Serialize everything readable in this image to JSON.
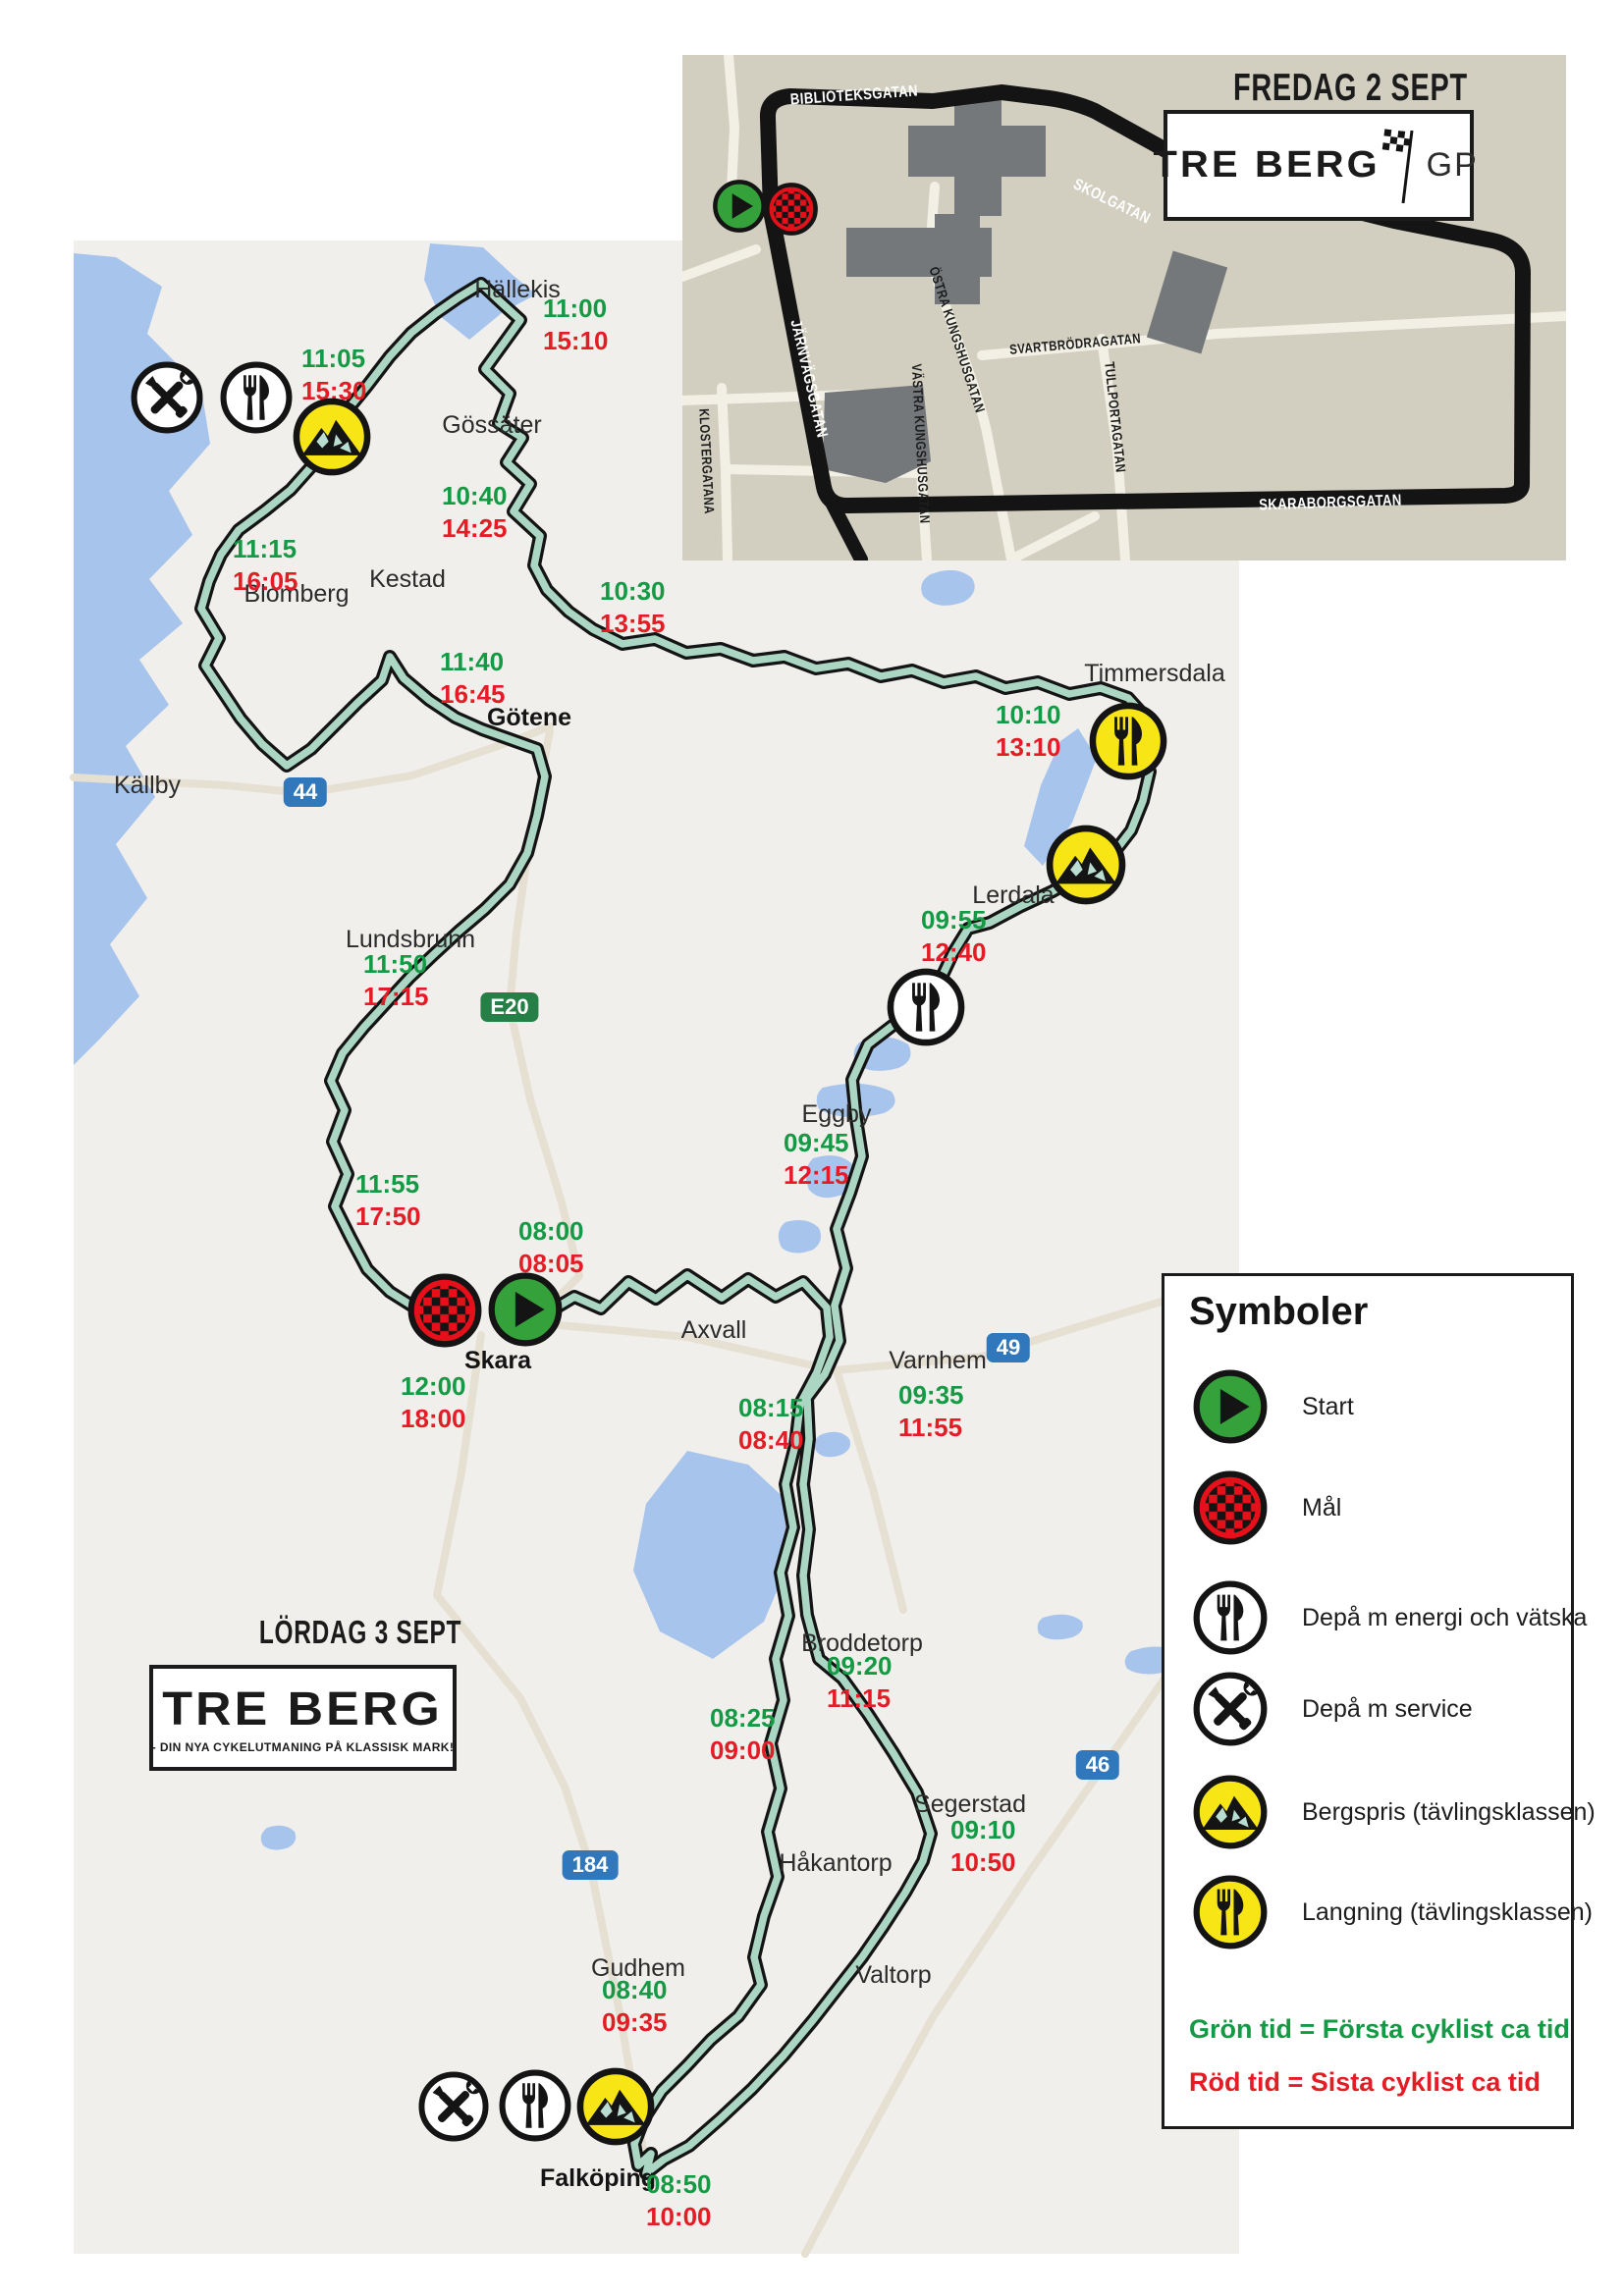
{
  "colors": {
    "map_bg": "#f0efec",
    "water": "#a6c4ec",
    "road": "#e6e0d2",
    "route_fill": "#abd6c4",
    "route_casing": "#141414",
    "green_time": "#149a44",
    "red_time": "#e31c25",
    "badge_blue": "#3077bc",
    "badge_green": "#267f46",
    "inset_bg": "#d2cfc0",
    "inset_street": "#f2f0e5",
    "building": "#75787b",
    "start_green": "#35a13b",
    "goal_red": "#e6101b",
    "prize_yellow": "#f7e516"
  },
  "inset": {
    "title": "FREDAG 2 SEPT",
    "logo_text": "TRE BERG",
    "logo_suffix": "GP",
    "streets": {
      "biblioteksgatan": "BIBLIOTEKSGATAN",
      "skolgatan": "SKOLGATAN",
      "jarnvagsgatan": "JÄRNVÄGSGATAN",
      "ostra_kungshusgatan": "ÖSTRA KUNGSHUSGATAN",
      "svartbrodragatan": "SVARTBRÖDRAGATAN",
      "tullportagatan": "TULLPORTAGATAN",
      "vastra_kungshusgatan": "VÄSTRA KUNGSHUSGATAN",
      "klostergatana": "KLOSTERGATANA",
      "skaraborgsgatan": "SKARABORGSGATAN"
    }
  },
  "main": {
    "day_title": "LÖRDAG 3 SEPT",
    "logo_text": "TRE BERG",
    "logo_tagline": "- DIN NYA CYKELUTMANING PÅ KLASSISK MARK!",
    "badges": {
      "r44": "44",
      "e20": "E20",
      "r49": "49",
      "r46": "46",
      "r184": "184"
    },
    "places": {
      "hallekis": "Hällekis",
      "gossater": "Gössäter",
      "kestad": "Kestad",
      "blomberg": "Blomberg",
      "gotene": "Götene",
      "kallby": "Källby",
      "lundsbrunn": "Lundsbrunn",
      "timmersdala": "Timmersdala",
      "lerdala": "Lerdala",
      "eggby": "Eggby",
      "skara": "Skara",
      "axvall": "Axvall",
      "varnhem": "Varnhem",
      "broddetorp": "Broddetorp",
      "hakantorp": "Håkantorp",
      "segerstad": "Segerstad",
      "valtorp": "Valtorp",
      "gudhem": "Gudhem",
      "falkoping": "Falköping"
    },
    "times": {
      "hallekis": {
        "g": "11:00",
        "r": "15:10"
      },
      "nw_bergspris": {
        "g": "11:05",
        "r": "15:30"
      },
      "gossater": {
        "g": "10:40",
        "r": "14:25"
      },
      "blomberg": {
        "g": "11:15",
        "r": "16:05"
      },
      "kestad_east": {
        "g": "10:30",
        "r": "13:55"
      },
      "gotene": {
        "g": "11:40",
        "r": "16:45"
      },
      "timmersdala": {
        "g": "10:10",
        "r": "13:10"
      },
      "lerdala": {
        "g": "09:55",
        "r": "12:40"
      },
      "eggby": {
        "g": "09:45",
        "r": "12:15"
      },
      "lundsbrunn": {
        "g": "11:50",
        "r": "17:15"
      },
      "south_lundsbrunn": {
        "g": "11:55",
        "r": "17:50"
      },
      "start": {
        "g": "08:00",
        "r": "08:05"
      },
      "mal": {
        "g": "12:00",
        "r": "18:00"
      },
      "axvall": {
        "g": "08:15",
        "r": "08:40"
      },
      "varnhem": {
        "g": "09:35",
        "r": "11:55"
      },
      "broddetorp": {
        "g": "09:20",
        "r": "11:15"
      },
      "west_broddetorp": {
        "g": "08:25",
        "r": "09:00"
      },
      "segerstad": {
        "g": "09:10",
        "r": "10:50"
      },
      "gudhem": {
        "g": "08:40",
        "r": "09:35"
      },
      "falkoping": {
        "g": "08:50",
        "r": "10:00"
      }
    }
  },
  "legend": {
    "title": "Symboler",
    "items": [
      {
        "icon": "start",
        "label": "Start"
      },
      {
        "icon": "mal",
        "label": "Mål"
      },
      {
        "icon": "depa-energi",
        "label": "Depå m energi och vätska"
      },
      {
        "icon": "depa-service",
        "label": "Depå m service"
      },
      {
        "icon": "bergspris",
        "label": "Bergspris (tävlingsklassen)"
      },
      {
        "icon": "langning",
        "label": "Langning (tävlingsklassen)"
      }
    ],
    "note_green": "Grön tid = Första cyklist ca tid",
    "note_red": "Röd tid = Sista cyklist ca tid"
  }
}
